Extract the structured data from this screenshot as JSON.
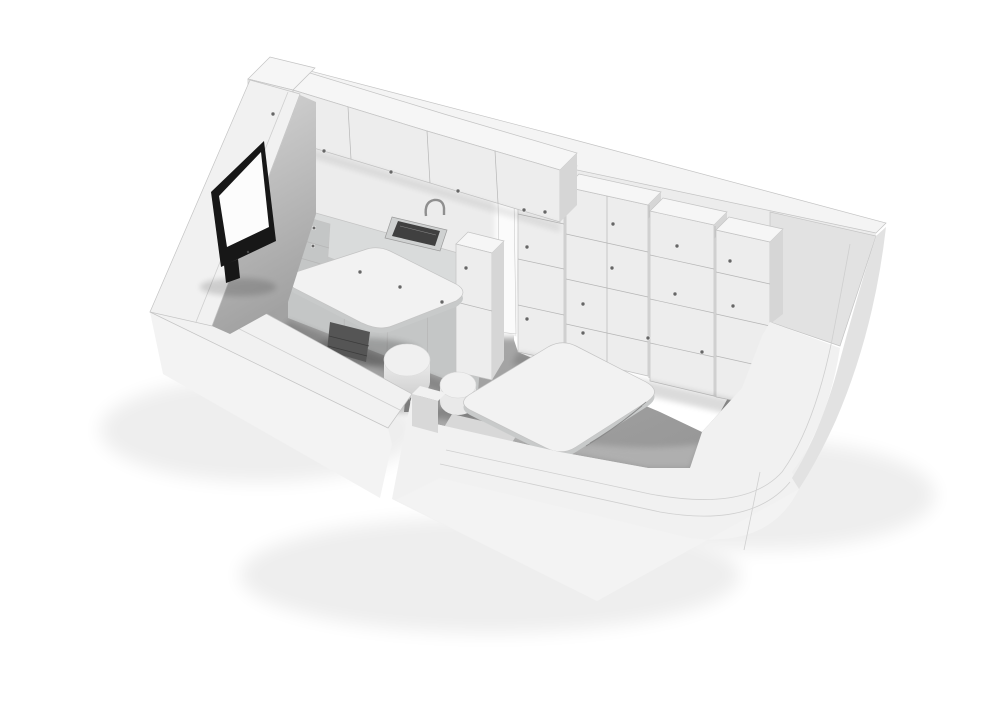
{
  "scene": {
    "kind": "3d-architectural-axonometric-cutaway-render",
    "room": "compact studio interior with kitchenette, storage wall and two desks",
    "objects": [
      "left wall with flat screen standing on wall top",
      "back wall with wall-mounted upper cabinets",
      "kitchen counter with sink and faucet",
      "base cabinet doors and drawer unit",
      "tall cabinet beside counter",
      "bright doorway opening with arched cut",
      "stepped storage cabinet wall with knob handles",
      "right wall and corner bench",
      "low front walls shown in cutaway",
      "left desk table with pedestal base",
      "center desk table with pedestal base",
      "round stool with tripod legs",
      "round pouf seat",
      "gray floor"
    ]
  },
  "palette": {
    "background": "#ffffff",
    "wallTop": "#f4f4f4",
    "wallFace": "#ececec",
    "wallInner": "#e2e2e2",
    "wallSide": "#d8d8d8",
    "cap": "#f1f1f1",
    "outerFace": "#f3f3f3",
    "floor": "#a6a6a6",
    "floorDark": "#949494",
    "cove": "#c9c9c9",
    "cabinetFace": "#ededed",
    "cabinetTop": "#f6f6f6",
    "cabinetSide": "#d6d6d6",
    "counterTop": "#d9dbdb",
    "counterFront": "#c4c6c6",
    "seam": "#b6b6b6",
    "knob": "#666666",
    "sinkRim": "#cfd1d1",
    "sinkBasin": "#404040",
    "faucet": "#8f8f8f",
    "tableTop": "#f2f2f2",
    "tableEdge": "#c8caca",
    "pedestal": "#555555",
    "stool": "#f0f0f0",
    "pouf": "#e9e9e9",
    "tvFrame": "#171717",
    "tvScreen": "#fcfcfc"
  }
}
